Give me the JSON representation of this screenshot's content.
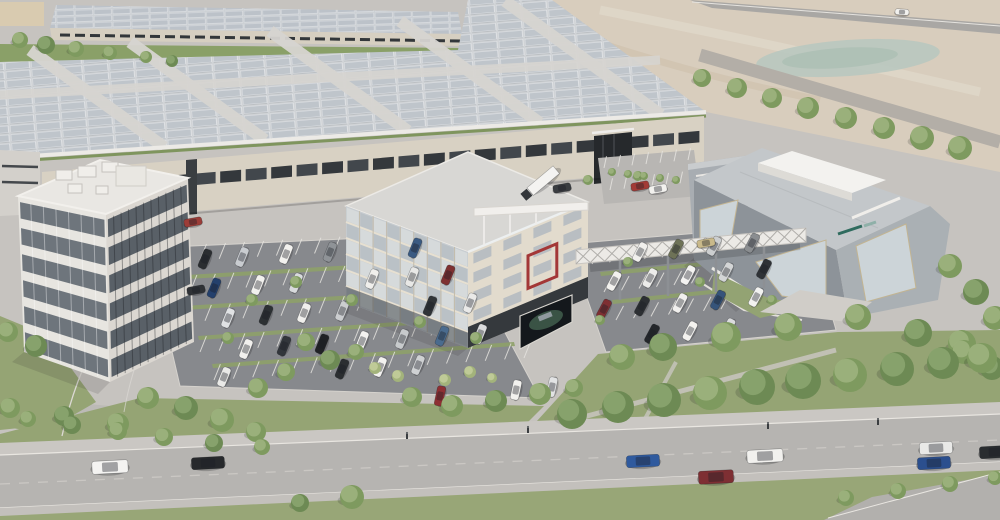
{
  "meta": {
    "description": "Aerial architectural rendering of an industrial campus: solar-roof factory halls, two office buildings, an angular experience center with sky-bridge, parking lots, landscaped boulevard with traffic, and undeveloped sandy terrain with a pond."
  },
  "palette": {
    "ground": "#c6c3bf",
    "road": "#b6b4b1",
    "asphalt": "#87898d",
    "grass": "#95a474",
    "sand": "#d8cdbd",
    "pond": "#b9c8bf",
    "facade_beige": "#d8d1c3",
    "window_dark": "#3b3f43",
    "solar_panel": "#bfc5cb",
    "building_gray": "#9aa0a5",
    "accent_red": "#a33737",
    "white": "#f1efec",
    "logo_teal": "#2f6b5e"
  },
  "buildings": {
    "left_office": {
      "floors": 6,
      "bays": 8
    },
    "center_office": {
      "floors": 6,
      "bays": 9,
      "end_rows": 4,
      "end_cols": 4,
      "accent": "red-frame",
      "rooftop": "pergola-terrace"
    },
    "factory_hall": {
      "roof": "solar-array",
      "ribbon_cols": 26
    },
    "experience_center": {
      "logo_color": "#2f6b5e"
    },
    "billboard": {
      "content": "car-advertisement-screen"
    }
  },
  "parking": {
    "center_rows": [
      [
        162,
        262,
        448,
        246,
        15
      ],
      [
        172,
        292,
        468,
        274,
        16
      ],
      [
        186,
        322,
        490,
        302,
        16
      ],
      [
        200,
        352,
        508,
        330,
        16
      ],
      [
        214,
        380,
        524,
        358,
        16
      ]
    ],
    "center_stall": {
      "len": 17,
      "angle": -68
    },
    "right_rows": [
      [
        592,
        264,
        802,
        244,
        12
      ],
      [
        604,
        292,
        814,
        271,
        12
      ],
      [
        616,
        320,
        826,
        298,
        12
      ]
    ],
    "right_stall": {
      "len": 16,
      "angle": -62
    },
    "small_rows": [
      [
        604,
        168,
        688,
        160,
        6
      ],
      [
        610,
        190,
        694,
        182,
        6
      ]
    ],
    "small_stall": {
      "len": 12,
      "angle": -78
    }
  },
  "vehicles": {
    "parked_center_angle": -68,
    "parked_center": [
      [
        205,
        259,
        "#2b2e31"
      ],
      [
        242,
        257,
        "#c9ccd0"
      ],
      [
        286,
        254,
        "#f2f1ee"
      ],
      [
        330,
        252,
        "#8f9397"
      ],
      [
        415,
        248,
        "#3a5a82"
      ],
      [
        214,
        288,
        "#24406c"
      ],
      [
        258,
        285,
        "#f2f1ee"
      ],
      [
        296,
        283,
        "#d8dadc"
      ],
      [
        372,
        279,
        "#f0efec"
      ],
      [
        412,
        277,
        "#e8e8e6"
      ],
      [
        448,
        275,
        "#7e3030"
      ],
      [
        228,
        318,
        "#e0e2e4"
      ],
      [
        266,
        315,
        "#2c3033"
      ],
      [
        304,
        313,
        "#f0efec"
      ],
      [
        342,
        311,
        "#cbcdcf"
      ],
      [
        430,
        306,
        "#303438"
      ],
      [
        470,
        303,
        "#e9e9e8"
      ],
      [
        246,
        349,
        "#f1f0ed"
      ],
      [
        284,
        346,
        "#32363b"
      ],
      [
        322,
        344,
        "#202225"
      ],
      [
        362,
        341,
        "#f3f2f0"
      ],
      [
        402,
        339,
        "#c7cacc"
      ],
      [
        442,
        336,
        "#4a6b8e"
      ],
      [
        480,
        334,
        "#dadbdc"
      ],
      [
        224,
        377,
        "#e9e9e7"
      ],
      [
        342,
        369,
        "#2b2e31"
      ],
      [
        380,
        367,
        "#f2f1ef"
      ],
      [
        418,
        365,
        "#cfd1d3"
      ]
    ],
    "parked_bottom_angle": -78,
    "parked_bottom": [
      [
        440,
        396,
        "#8e2f33"
      ],
      [
        516,
        390,
        "#f2f1ee"
      ],
      [
        552,
        387,
        "#e2e3e4"
      ]
    ],
    "parked_right_angle": -62,
    "parked_right": [
      [
        640,
        252,
        "#f1f0ed"
      ],
      [
        676,
        249,
        "#6e7257"
      ],
      [
        714,
        246,
        "#cccecf"
      ],
      [
        752,
        243,
        "#8a8d90"
      ],
      [
        614,
        281,
        "#f2f1ee"
      ],
      [
        650,
        278,
        "#ececea"
      ],
      [
        688,
        275,
        "#f4f3f1"
      ],
      [
        726,
        272,
        "#d3d5d6"
      ],
      [
        764,
        269,
        "#2f3236"
      ],
      [
        604,
        309,
        "#7e2f33"
      ],
      [
        642,
        306,
        "#2c2f33"
      ],
      [
        680,
        303,
        "#f1f0ee"
      ],
      [
        718,
        300,
        "#36547a"
      ],
      [
        756,
        297,
        "#f2f2f0"
      ],
      [
        652,
        334,
        "#24272b"
      ],
      [
        690,
        331,
        "#f3f2ef"
      ],
      [
        728,
        328,
        "#dadbdd"
      ]
    ],
    "parked_small_angle": -10,
    "parked_small": [
      [
        640,
        186,
        "#a23a36"
      ],
      [
        658,
        189,
        "#f2f1ee"
      ],
      [
        706,
        243,
        "#c9b98a"
      ],
      [
        193,
        222,
        "#9c3d38"
      ],
      [
        196,
        290,
        "#2f3236"
      ],
      [
        562,
        188,
        "#3a3d41"
      ]
    ],
    "road": [
      [
        110,
        467,
        "#f4f3f1",
        -3,
        36,
        13
      ],
      [
        208,
        463,
        "#27292c",
        -3,
        33,
        12
      ],
      [
        643,
        461,
        "#2f5a9e",
        -3,
        33,
        12
      ],
      [
        716,
        477,
        "#7e2f33",
        -3,
        35,
        13
      ],
      [
        765,
        456,
        "#f2f1ee",
        -3,
        36,
        13
      ],
      [
        936,
        448,
        "#e9e9e7",
        -3,
        33,
        12
      ],
      [
        934,
        463,
        "#2b4f8e",
        -3,
        33,
        12
      ],
      [
        996,
        452,
        "#2a2d30",
        -3,
        33,
        12
      ]
    ],
    "top_road_truck": [
      902,
      12,
      "#f2f1ee",
      4,
      14,
      6
    ]
  },
  "trees": [
    [
      702,
      78,
      9,
      1
    ],
    [
      737,
      88,
      10,
      1
    ],
    [
      772,
      98,
      10,
      1
    ],
    [
      808,
      108,
      11,
      1
    ],
    [
      846,
      118,
      11,
      1
    ],
    [
      884,
      128,
      11,
      1
    ],
    [
      922,
      138,
      12,
      1
    ],
    [
      960,
      148,
      12,
      1
    ],
    [
      20,
      40,
      8,
      1
    ],
    [
      46,
      45,
      9,
      2
    ],
    [
      76,
      49,
      8,
      1
    ],
    [
      110,
      53,
      7,
      1
    ],
    [
      146,
      57,
      6,
      1
    ],
    [
      172,
      61,
      6,
      2
    ],
    [
      950,
      266,
      12,
      1
    ],
    [
      976,
      292,
      13,
      2
    ],
    [
      995,
      318,
      12,
      1
    ],
    [
      962,
      344,
      14,
      1
    ],
    [
      992,
      368,
      12,
      2
    ],
    [
      622,
      357,
      13,
      1
    ],
    [
      663,
      347,
      14,
      2
    ],
    [
      726,
      337,
      15,
      1
    ],
    [
      788,
      327,
      14,
      1
    ],
    [
      858,
      317,
      13,
      1
    ],
    [
      918,
      333,
      14,
      2
    ],
    [
      964,
      352,
      12,
      1
    ],
    [
      572,
      414,
      15,
      2
    ],
    [
      618,
      407,
      16,
      2
    ],
    [
      664,
      400,
      17,
      2
    ],
    [
      710,
      393,
      17,
      1
    ],
    [
      757,
      387,
      18,
      2
    ],
    [
      803,
      381,
      18,
      2
    ],
    [
      850,
      375,
      17,
      1
    ],
    [
      897,
      369,
      17,
      2
    ],
    [
      943,
      363,
      16,
      2
    ],
    [
      982,
      358,
      15,
      1
    ],
    [
      412,
      397,
      10,
      1
    ],
    [
      452,
      406,
      11,
      1
    ],
    [
      496,
      401,
      11,
      2
    ],
    [
      540,
      394,
      11,
      1
    ],
    [
      574,
      388,
      9,
      1
    ],
    [
      470,
      372,
      6,
      0
    ],
    [
      445,
      380,
      6,
      0
    ],
    [
      492,
      378,
      5,
      0
    ],
    [
      306,
      342,
      9,
      1
    ],
    [
      330,
      360,
      10,
      2
    ],
    [
      286,
      372,
      9,
      1
    ],
    [
      258,
      388,
      10,
      1
    ],
    [
      356,
      352,
      8,
      1
    ],
    [
      375,
      368,
      6,
      0
    ],
    [
      398,
      376,
      6,
      0
    ],
    [
      588,
      180,
      5,
      1
    ],
    [
      638,
      176,
      5,
      1
    ],
    [
      8,
      332,
      10,
      1
    ],
    [
      36,
      346,
      11,
      2
    ],
    [
      148,
      398,
      11,
      1
    ],
    [
      186,
      408,
      12,
      2
    ],
    [
      222,
      420,
      12,
      1
    ],
    [
      118,
      424,
      11,
      1
    ],
    [
      64,
      416,
      10,
      2
    ],
    [
      256,
      432,
      10,
      1
    ],
    [
      252,
      300,
      6,
      1
    ],
    [
      296,
      282,
      6,
      1
    ],
    [
      352,
      300,
      6,
      1
    ],
    [
      420,
      322,
      6,
      1
    ],
    [
      476,
      338,
      6,
      1
    ],
    [
      228,
      338,
      6,
      1
    ],
    [
      628,
      262,
      5,
      1
    ],
    [
      700,
      282,
      5,
      1
    ],
    [
      772,
      300,
      5,
      1
    ],
    [
      600,
      320,
      5,
      1
    ],
    [
      846,
      498,
      8,
      1
    ],
    [
      898,
      491,
      8,
      1
    ],
    [
      950,
      484,
      8,
      1
    ],
    [
      995,
      478,
      7,
      1
    ],
    [
      28,
      419,
      8,
      1
    ],
    [
      72,
      425,
      9,
      2
    ],
    [
      118,
      431,
      9,
      1
    ],
    [
      164,
      437,
      9,
      1
    ],
    [
      214,
      443,
      9,
      2
    ],
    [
      262,
      447,
      8,
      1
    ],
    [
      10,
      408,
      10,
      1
    ],
    [
      352,
      497,
      12,
      1
    ],
    [
      300,
      503,
      9,
      2
    ],
    [
      612,
      172,
      4,
      1
    ],
    [
      628,
      174,
      4,
      1
    ],
    [
      644,
      176,
      4,
      1
    ],
    [
      660,
      178,
      4,
      1
    ],
    [
      676,
      180,
      4,
      1
    ]
  ],
  "pedestrians": [
    [
      407,
      438
    ],
    [
      528,
      432
    ],
    [
      768,
      428
    ],
    [
      878,
      424
    ]
  ]
}
